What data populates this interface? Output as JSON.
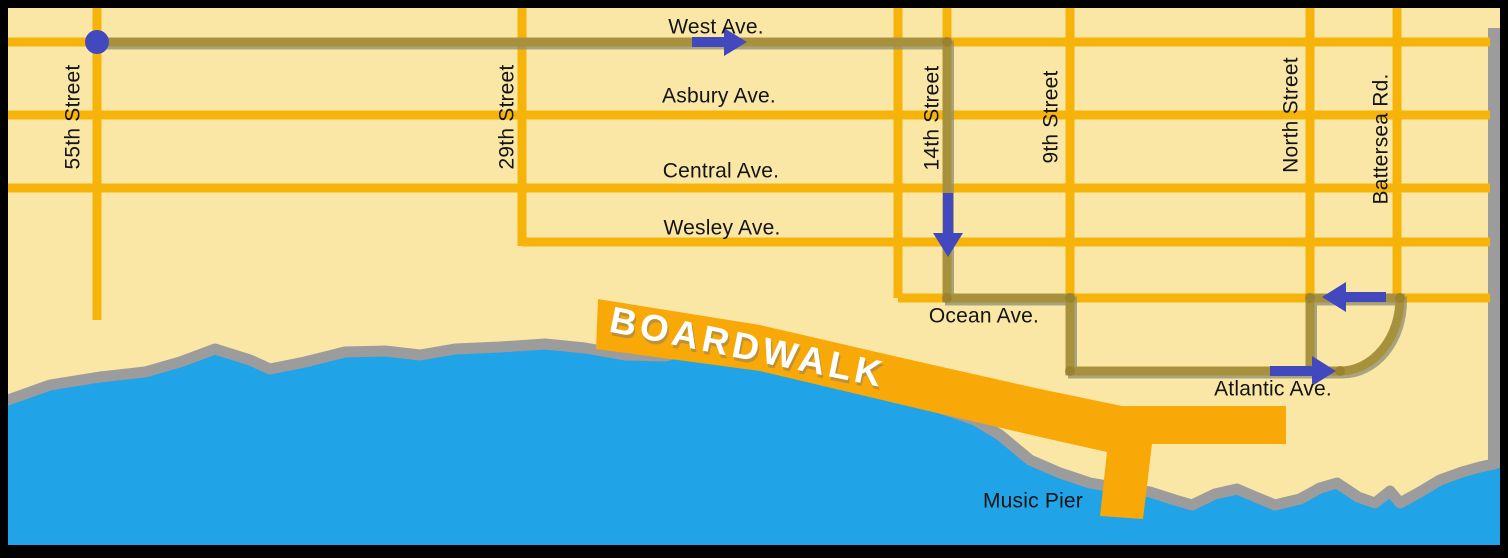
{
  "labels": {
    "west_ave": "West Ave.",
    "asbury_ave": "Asbury Ave.",
    "central_ave": "Central Ave.",
    "wesley_ave": "Wesley Ave.",
    "ocean_ave": "Ocean Ave.",
    "atlantic_ave": "Atlantic Ave.",
    "street_55": "55th Street",
    "street_29": "29th Street",
    "street_14": "14th Street",
    "street_9": "9th Street",
    "north_street": "North Street",
    "battersea_rd": "Battersea Rd.",
    "boardwalk": "BOARDWALK",
    "music_pier": "Music Pier"
  },
  "route": {
    "start_marker": "blue dot at 55th Street and West Ave.",
    "path_streets": [
      "West Ave.",
      "14th Street",
      "Ocean Ave.",
      "9th Street",
      "Atlantic Ave.",
      "loop at Battersea Rd.",
      "Ocean Ave.",
      "North Street"
    ],
    "arrows": [
      {
        "direction": "east",
        "on": "West Ave."
      },
      {
        "direction": "south",
        "on": "14th Street"
      },
      {
        "direction": "east",
        "on": "Atlantic Ave."
      },
      {
        "direction": "west",
        "on": "Ocean Ave."
      }
    ]
  },
  "colors": {
    "land": "#FBE7A5",
    "street": "#F6B40B",
    "route_line": "#A8913C",
    "route_marker_blue": "#4249BE",
    "water": "#21A3E7",
    "shoreline": "#9C9C9C",
    "boardwalk": "#F8A908",
    "border": "#000000",
    "label_text": "#141414",
    "boardwalk_text": "#FFFFFF"
  }
}
